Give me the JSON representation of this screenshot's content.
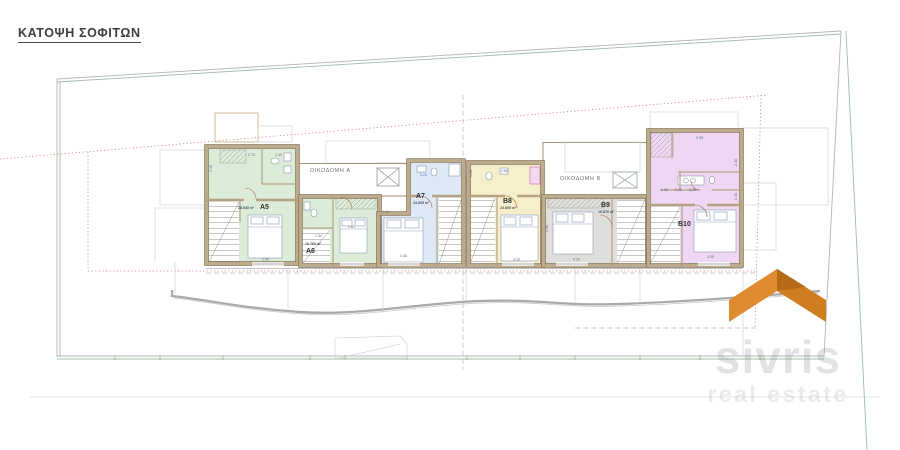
{
  "title": "ΚΑΤΟΨΗ ΣΟΦΙΤΩΝ",
  "buildings": {
    "a": "ΟΙΚΟΔΟΜΗ Α",
    "b": "ΟΙΚΟΔΟΜΗ Β"
  },
  "units": [
    {
      "id": "A5",
      "area": "28.935 m²",
      "dims": [
        "2.73",
        "1.40",
        "2.38",
        "2.90"
      ]
    },
    {
      "id": "A6",
      "area": "19.760 m²",
      "dims": [
        "1.34",
        "2.81"
      ]
    },
    {
      "id": "A7",
      "area": "23.005 m²",
      "dims": [
        "2.24",
        "1.94",
        "3.45"
      ]
    },
    {
      "id": "B8",
      "area": "23.805 m²",
      "dims": [
        "2.65",
        "1.08",
        "3.10"
      ]
    },
    {
      "id": "B9",
      "area": "19.876 m²",
      "dims": [
        "2.95",
        "4.20"
      ]
    },
    {
      "id": "B10",
      "area": "",
      "dims": [
        "3.95",
        "2.36",
        "0.85",
        "0.26",
        "2.00",
        "1.45",
        "3.05"
      ]
    }
  ],
  "watermark": {
    "line1": "sivris",
    "line2": "real estate"
  },
  "colors": {
    "logo_light": "#de8c2f",
    "logo_mid": "#d07e22",
    "logo_dark": "#b56a15",
    "wall": "#bcac8c",
    "wall_edge": "#8a7a5e",
    "unit_A5": "#dcecd8",
    "unit_A6": "#dcecd8",
    "unit_A7": "#dfe8f5",
    "unit_B8": "#f6efcb",
    "unit_B9": "#dededc",
    "unit_B10": "#eed7f2",
    "boundary_green": "#a3bca6",
    "roof_dashed_red": "#c97f6f",
    "closet_pink": "#d26fc4"
  }
}
